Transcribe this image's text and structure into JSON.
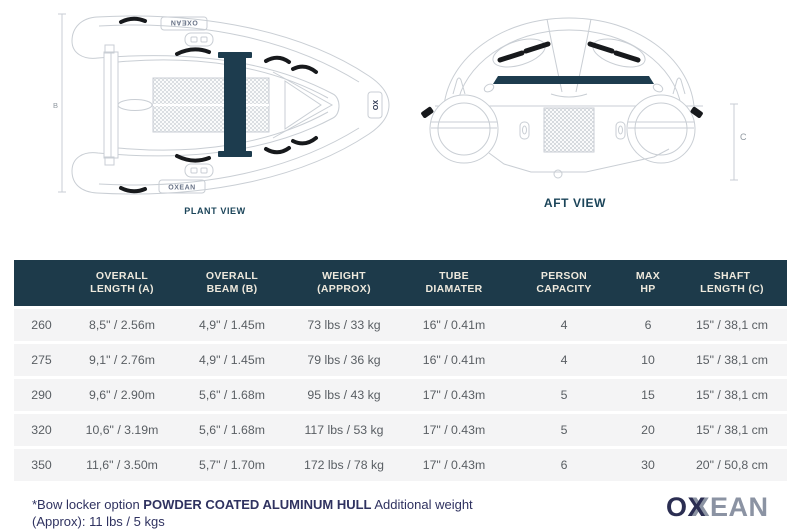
{
  "drawings": {
    "plant": {
      "label": "PLANT VIEW",
      "dim": "B",
      "tube_logo": "OXEAN",
      "bow_logo": "OX"
    },
    "aft": {
      "label": "AFT VIEW",
      "dim": "C"
    }
  },
  "table": {
    "headers": [
      "",
      "OVERALL LENGTH (A)",
      "OVERALL BEAM (B)",
      "WEIGHT (APPROX)",
      "TUBE DIAMATER",
      "PERSON CAPACITY",
      "MAX HP",
      "SHAFT LENGTH (C)"
    ],
    "rows": [
      [
        "260",
        "8,5\" / 2.56m",
        "4,9\" / 1.45m",
        "73 lbs / 33 kg",
        "16\" / 0.41m",
        "4",
        "6",
        "15\" / 38,1 cm"
      ],
      [
        "275",
        "9,1\" / 2.76m",
        "4,9\" / 1.45m",
        "79 lbs / 36 kg",
        "16\" / 0.41m",
        "4",
        "10",
        "15\" / 38,1 cm"
      ],
      [
        "290",
        "9,6\" / 2.90m",
        "5,6\" / 1.68m",
        "95 lbs / 43 kg",
        "17\" / 0.43m",
        "5",
        "15",
        "15\" / 38,1 cm"
      ],
      [
        "320",
        "10,6\" / 3.19m",
        "5,6\" / 1.68m",
        "117 lbs / 53 kg",
        "17\" / 0.43m",
        "5",
        "20",
        "15\" / 38,1 cm"
      ],
      [
        "350",
        "11,6\" / 3.50m",
        "5,7\" / 1.70m",
        "172 lbs / 78 kg",
        "17\" / 0.43m",
        "6",
        "30",
        "20\" / 50,8 cm"
      ]
    ]
  },
  "footer": {
    "note_prefix": "*Bow locker option ",
    "note_bold": "POWDER COATED ALUMINUM HULL",
    "note_suffix": " Additional weight (Approx): 11 lbs / 5 kgs",
    "logo_o": "O",
    "logo_x": "X",
    "logo_rest": "EAN"
  },
  "colors": {
    "header_bg": "#1d3a4a",
    "drawing_navy": "#1d3c4e",
    "line_gray": "#c9ced4",
    "logo_navy": "#2b2e52",
    "logo_gray": "#8b93a3"
  }
}
